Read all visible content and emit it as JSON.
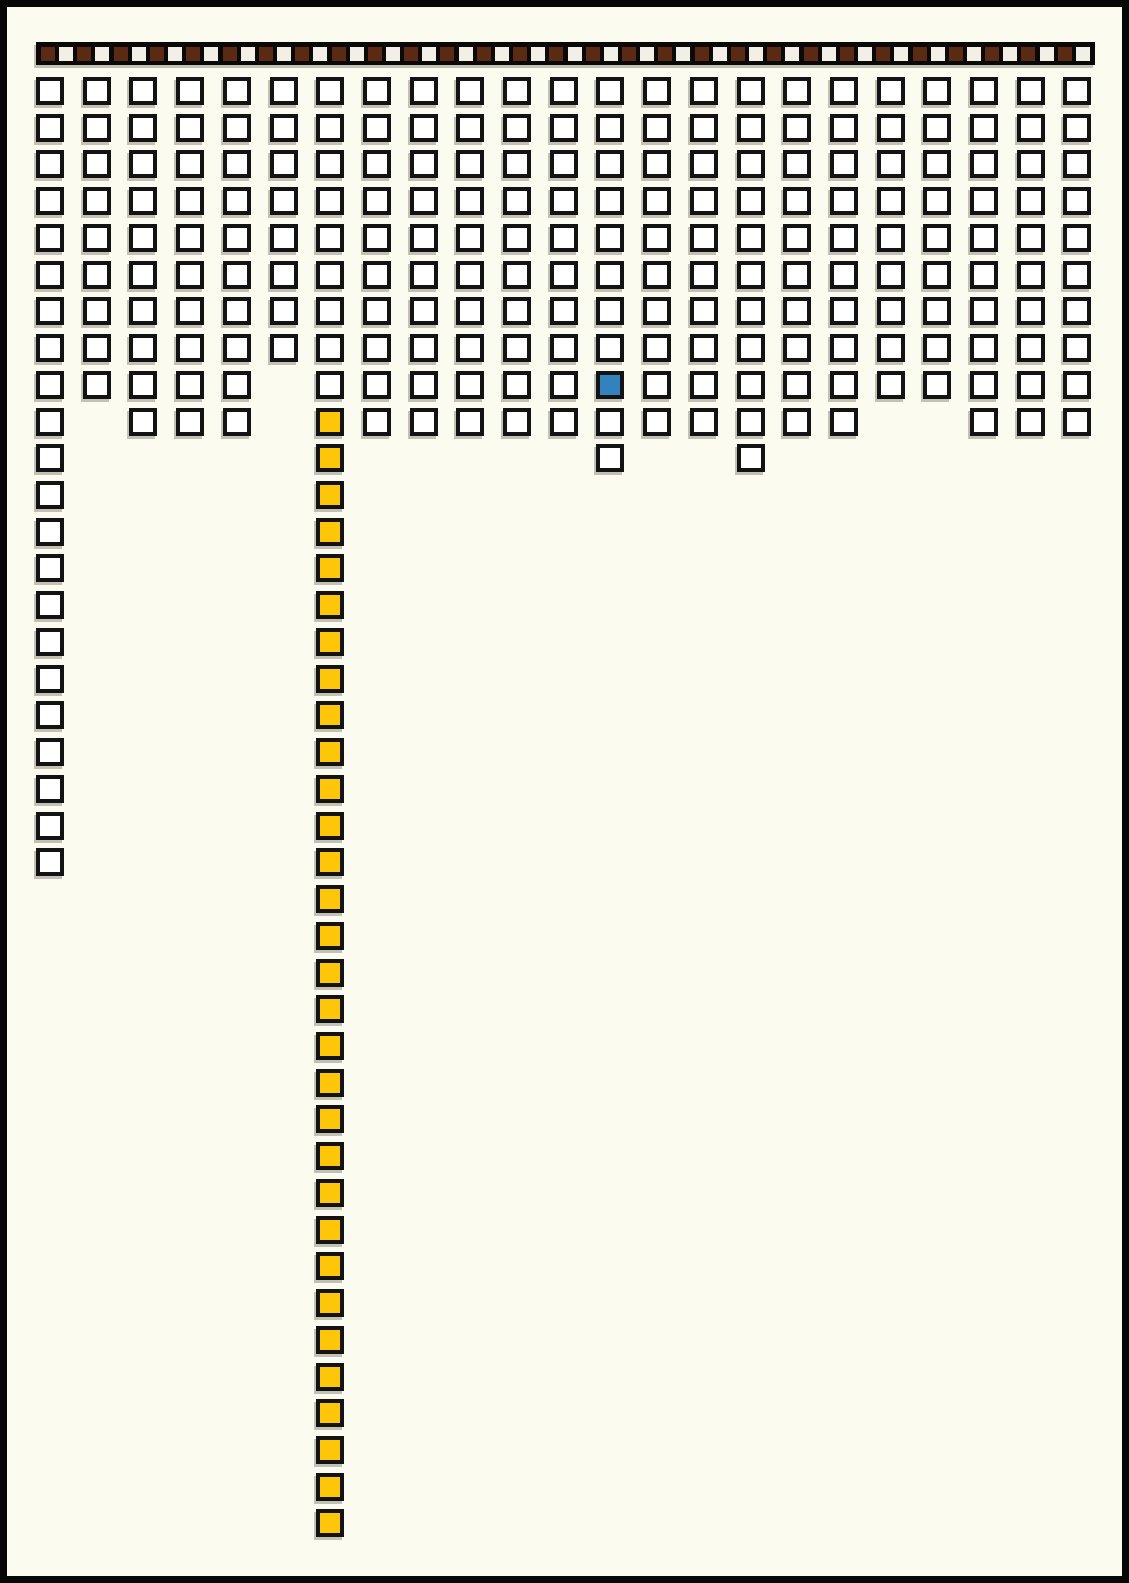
{
  "page": {
    "background": "#FCFBEF",
    "frame_color": "#070707"
  },
  "chart_data": {
    "type": "heatmap",
    "title": "",
    "subtitle": "",
    "axis_labels": {
      "x": "",
      "y": ""
    },
    "legend_position": "none",
    "grid_lines": false,
    "palette": {
      "cell_fill_white": "#FFFFFF",
      "cell_border": "#131313",
      "cell_fill_blue": "#3182BD",
      "cell_fill_yellow": "#FDC608",
      "strip_bar": "#0B0907",
      "strip_chip_dark": "#5B2A14",
      "strip_chip_light": "#F1EFE6",
      "shadow": "#7D7A6A"
    },
    "header_strip": {
      "chip_count": 58,
      "dark_chip_count": 29,
      "light_chip_count": 29,
      "pattern": "DLDLDLDLDLDLDLDLDLDLDLDLDLDLDLDLDLDLDLDLDLDLDLDLDLDLDLDLDL",
      "chip_codes": {
        "D": "dark-brown",
        "L": "light"
      }
    },
    "grid": {
      "columns": 23,
      "rows": 40,
      "cell_codes": {
        ".": "empty",
        "W": "white",
        "B": "blue",
        "Y": "yellow"
      },
      "rows_pattern": [
        "WWWWWWWWWWWWWWWWWWWWWWW",
        "WWWWWWWWWWWWWWWWWWWWWWW",
        "WWWWWWWWWWWWWWWWWWWWWWW",
        "WWWWWWWWWWWWWWWWWWWWWWW",
        "WWWWWWWWWWWWWWWWWWWWWWW",
        "WWWWWWWWWWWWWWWWWWWWWWW",
        "WWWWWWWWWWWWWWWWWWWWWWW",
        "WWWWWWWWWWWWWWWWWWWWWWW",
        "WWWWW.WWWWWWBWWWWWWWWWW",
        "W.WWW.YWWWWWWWWWWW..WWW",
        "W.....Y.....W..W.......",
        "W.....Y................",
        "W.....Y................",
        "W.....Y................",
        "W.....Y................",
        "W.....Y................",
        "W.....Y................",
        "W.....Y................",
        "W.....Y................",
        "W.....Y................",
        "W.....Y................",
        "W.....Y................",
        "......Y................",
        "......Y................",
        "......Y................",
        "......Y................",
        "......Y................",
        "......Y................",
        "......Y................",
        "......Y................",
        "......Y................",
        "......Y................",
        "......Y................",
        "......Y................",
        "......Y................",
        "......Y................",
        "......Y................",
        "......Y................",
        "......Y................",
        "......Y................"
      ],
      "counts": {
        "white_cells": 237,
        "blue_cells": 1,
        "yellow_cells": 31,
        "total_cells": 269
      },
      "highlights": {
        "blue_cell": {
          "row": 9,
          "column": 13
        },
        "yellow_column": {
          "column": 7,
          "from_row": 10,
          "to_row": 40
        },
        "left_tail_column": {
          "column": 1,
          "from_row": 1,
          "to_row": 22
        }
      }
    }
  }
}
